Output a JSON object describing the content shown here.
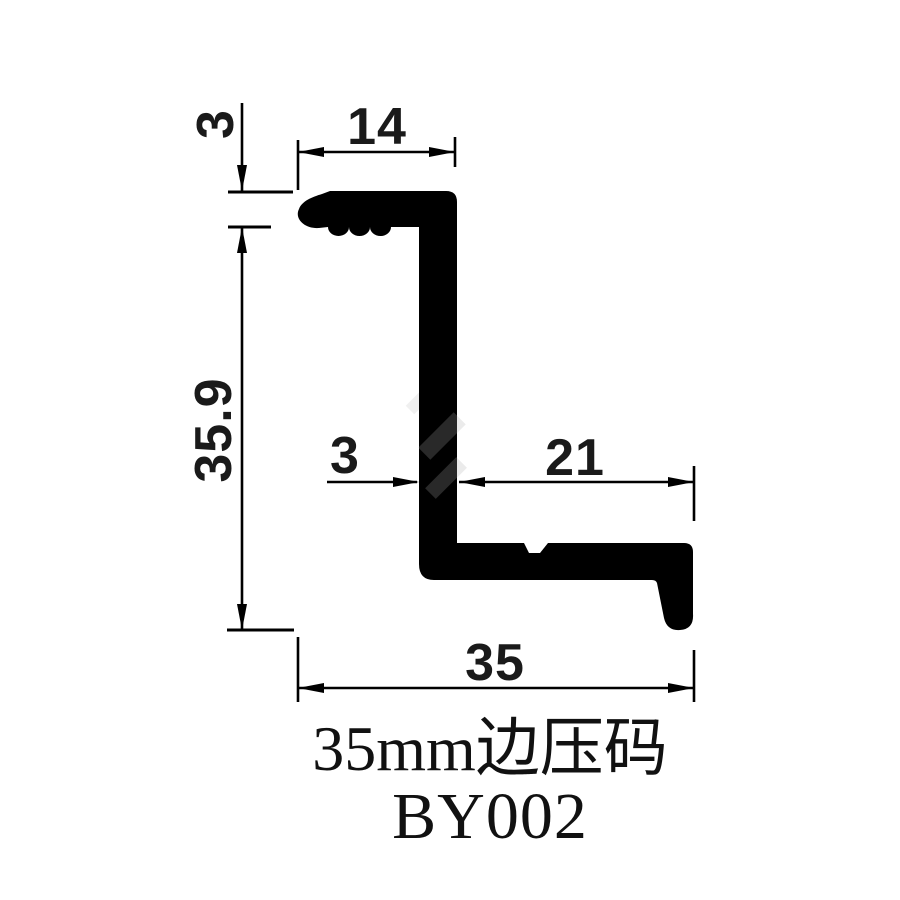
{
  "drawing": {
    "kind": "extrusion-profile-cross-section",
    "dimensions": {
      "top_thickness": "3",
      "top_width": "14",
      "height": "35.9",
      "web_thickness": "3",
      "bottom_length": "21",
      "overall_width": "35"
    },
    "caption": {
      "title": "35mm边压码",
      "model": "BY002"
    },
    "colors": {
      "line": "#000000",
      "profile_fill": "#000000",
      "background": "#ffffff",
      "watermark": "#e7e7e7"
    }
  }
}
